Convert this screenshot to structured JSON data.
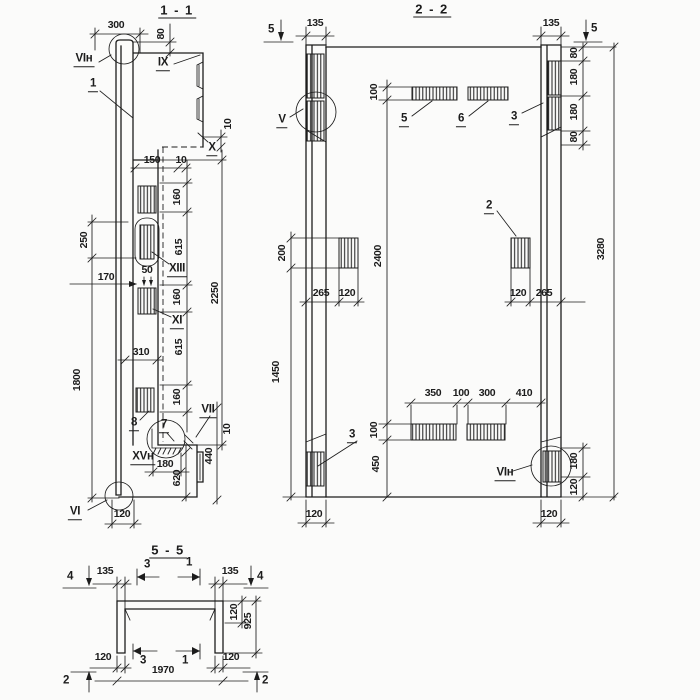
{
  "meta": {
    "line_color": "#1c1c1c",
    "background": "#fbfbfa"
  },
  "s11": {
    "title": "1 - 1",
    "labels": {
      "detail_vi_n": "VIн",
      "part_1": "1",
      "view_ix": "IX",
      "view_x": "X",
      "view_xiii": "XIII",
      "view_xi": "XI",
      "part_8": "8",
      "part_7": "7",
      "view_vii": "VII",
      "view_xv_n": "XVн",
      "view_vi": "VI"
    },
    "dims": {
      "d300": "300",
      "d80": "80",
      "d10_top": "10",
      "d150": "150",
      "d10_step": "10",
      "d160a": "160",
      "d615a": "615",
      "d160b": "160",
      "d615b": "615",
      "d160c": "160",
      "d2250": "2250",
      "d250": "250",
      "d170": "170",
      "d50": "50",
      "d310": "310",
      "d1800": "1800",
      "d180": "180",
      "d620": "620",
      "d440": "440",
      "d10_bot": "10",
      "d120": "120"
    }
  },
  "s22": {
    "title": "2 - 2",
    "labels": {
      "view_v": "V",
      "part_5": "5",
      "part_6": "6",
      "part_3_top": "3",
      "part_2": "2",
      "part_3_bot": "3",
      "view_vi_n": "VIн"
    },
    "markers": {
      "cut5_left": "5",
      "cut5_right": "5"
    },
    "dims": {
      "d135_left": "135",
      "d135_right": "135",
      "d100_top": "100",
      "d80a": "80",
      "d180a": "180",
      "d180b": "180",
      "d80b": "80",
      "d200": "200",
      "d1450": "1450",
      "d265_left": "265",
      "d120_left": "120",
      "d120_right": "120",
      "d265_right": "265",
      "d2400": "2400",
      "d3280": "3280",
      "d350": "350",
      "d100_mid": "100",
      "d300": "300",
      "d410": "410",
      "d100_bot": "100",
      "d450": "450",
      "d180_bot": "180",
      "d120_bot": "120",
      "d120_col_left": "120",
      "d120_col_right": "120"
    }
  },
  "s55": {
    "title": "5 - 5",
    "markers": {
      "cut4_left": "4",
      "cut3_top": "3",
      "cut1_top": "1",
      "cut4_right": "4",
      "cut3_bot": "3",
      "cut1_bot": "1",
      "cut2_left": "2",
      "cut2_right": "2"
    },
    "dims": {
      "d135_left": "135",
      "d135_right": "135",
      "d120_right": "120",
      "d925": "925",
      "d120_bot_left": "120",
      "d120_bot_right": "120",
      "d1970": "1970"
    }
  }
}
